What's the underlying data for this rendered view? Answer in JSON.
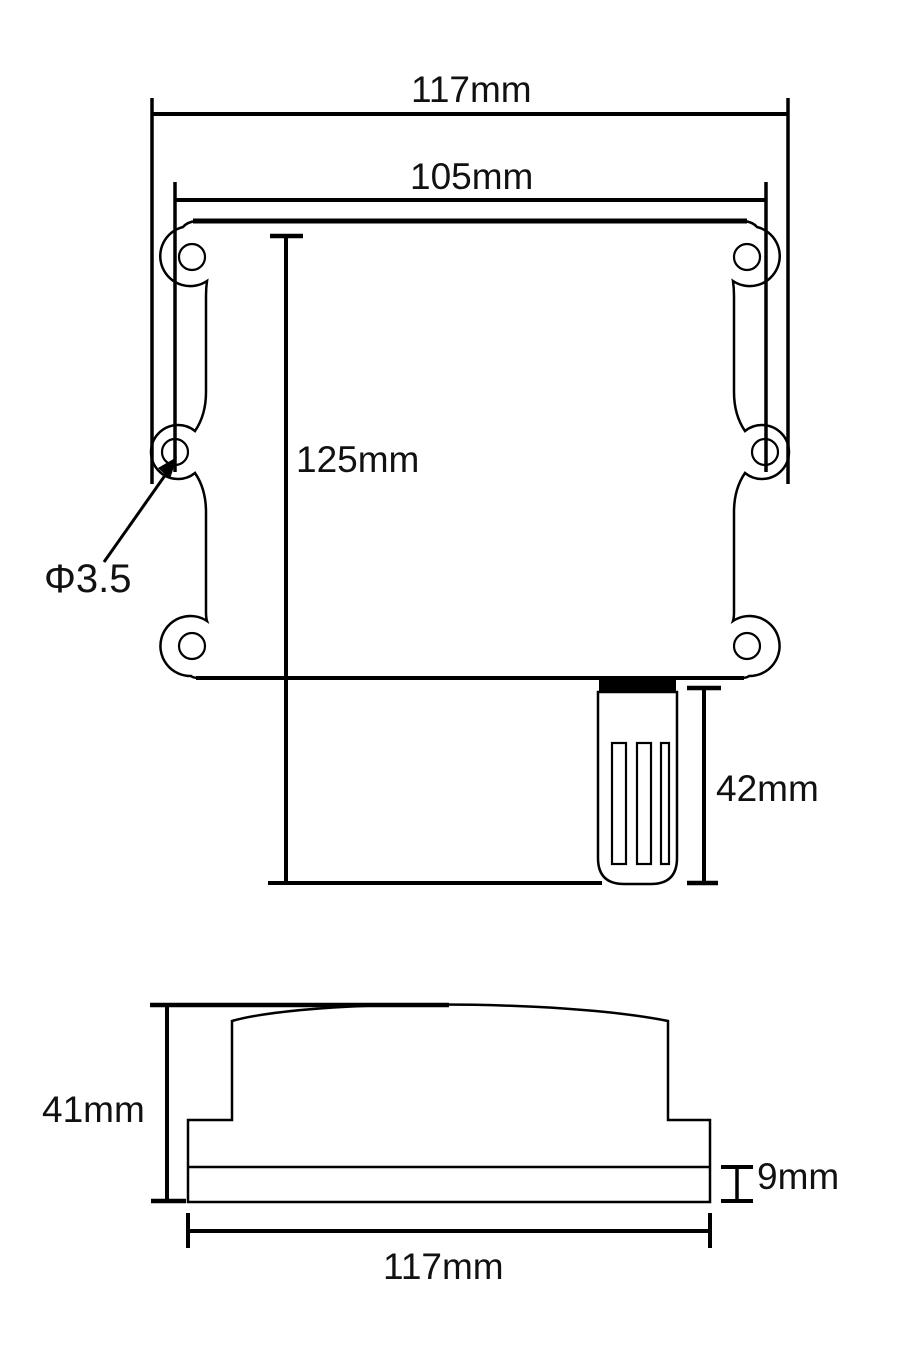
{
  "page": {
    "background_color": "#ffffff",
    "line_color": "#000000"
  },
  "front_view": {
    "labels": {
      "overall_width": "117mm",
      "mounting_hole_spacing": "105mm",
      "body_height": "125mm",
      "mounting_hole_diameter": "Φ3.5",
      "probe_length": "42mm"
    }
  },
  "side_view": {
    "labels": {
      "overall_height": "41mm",
      "base_thickness": "9mm",
      "overall_width": "117mm"
    }
  }
}
